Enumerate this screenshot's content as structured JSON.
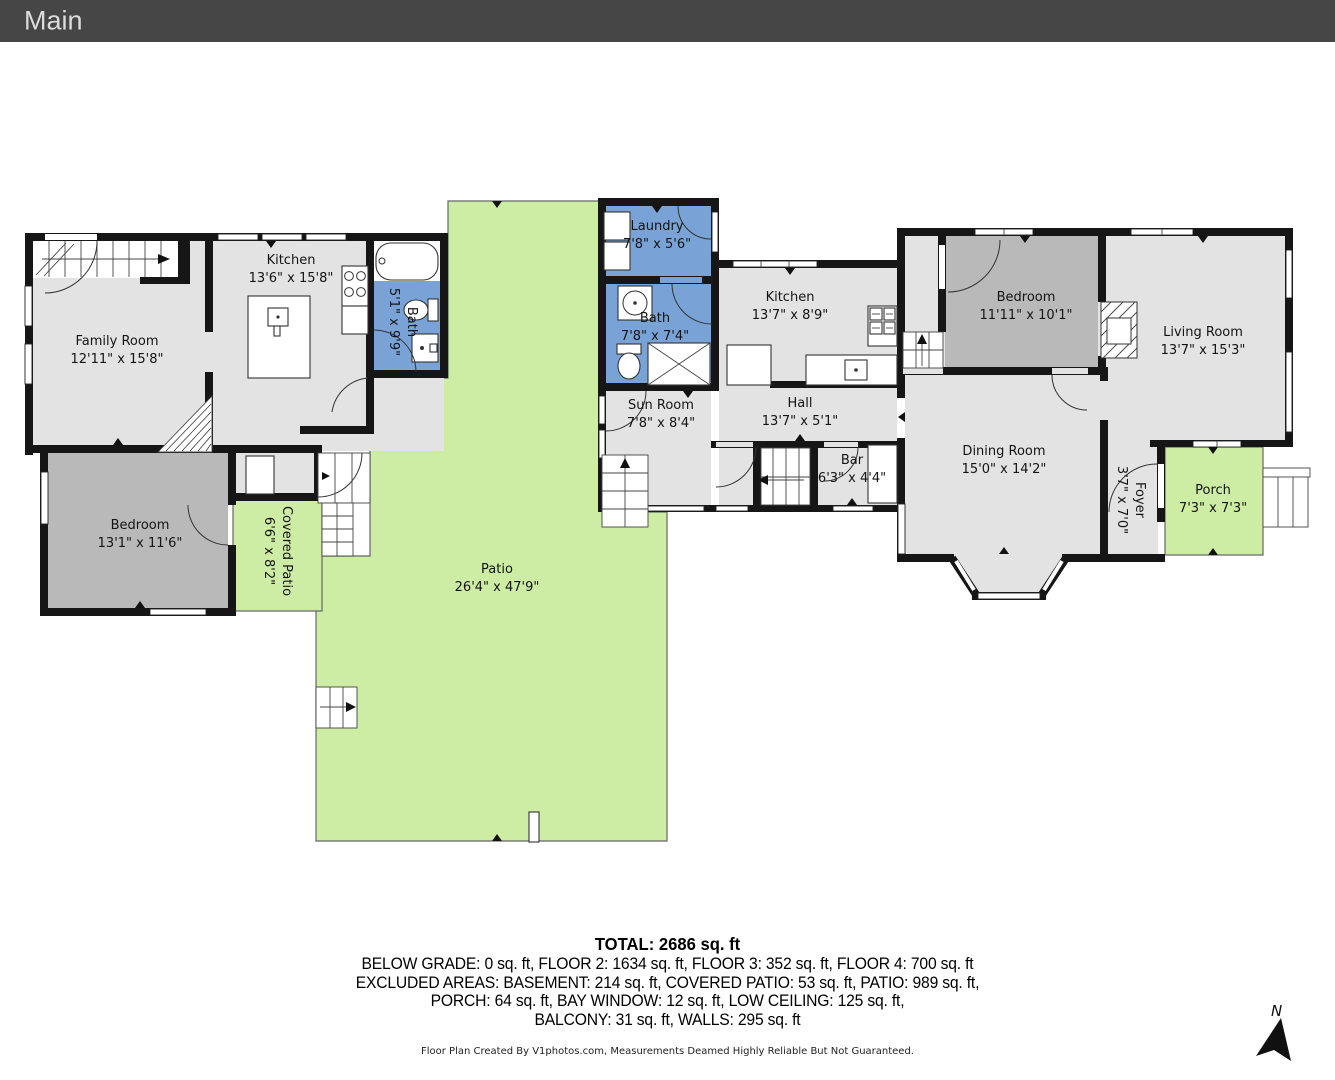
{
  "header": {
    "title": "Main"
  },
  "floorplan": {
    "rooms": [
      {
        "id": "family-room",
        "name": "Family Room",
        "dims": "12'11\" x 15'8\""
      },
      {
        "id": "kitchen-left",
        "name": "Kitchen",
        "dims": "13'6\" x 15'8\""
      },
      {
        "id": "bath-left",
        "name": "Bath",
        "dims": "5'1\" x 9'9\""
      },
      {
        "id": "bedroom-left",
        "name": "Bedroom",
        "dims": "13'1\" x 11'6\""
      },
      {
        "id": "covered-patio",
        "name": "Covered Patio",
        "dims": "6'6\" x 8'2\""
      },
      {
        "id": "patio",
        "name": "Patio",
        "dims": "26'4\" x 47'9\""
      },
      {
        "id": "laundry",
        "name": "Laundry",
        "dims": "7'8\" x 5'6\""
      },
      {
        "id": "bath-middle",
        "name": "Bath",
        "dims": "7'8\" x 7'4\""
      },
      {
        "id": "kitchen-middle",
        "name": "Kitchen",
        "dims": "13'7\" x 8'9\""
      },
      {
        "id": "sun-room",
        "name": "Sun Room",
        "dims": "7'8\" x 8'4\""
      },
      {
        "id": "hall",
        "name": "Hall",
        "dims": "13'7\" x 5'1\""
      },
      {
        "id": "bar",
        "name": "Bar",
        "dims": "6'3\" x 4'4\""
      },
      {
        "id": "bedroom-right",
        "name": "Bedroom",
        "dims": "11'11\" x 10'1\""
      },
      {
        "id": "living-room",
        "name": "Living Room",
        "dims": "13'7\" x 15'3\""
      },
      {
        "id": "dining-room",
        "name": "Dining Room",
        "dims": "15'0\" x 14'2\""
      },
      {
        "id": "foyer",
        "name": "Foyer",
        "dims": "3'7\" x 7'0\""
      },
      {
        "id": "porch",
        "name": "Porch",
        "dims": "7'3\" x 7'3\""
      }
    ],
    "compass_label": "N"
  },
  "summary": {
    "total": "TOTAL: 2686 sq. ft",
    "line2": "BELOW GRADE: 0 sq. ft, FLOOR 2: 1634 sq. ft, FLOOR 3: 352 sq. ft, FLOOR 4: 700 sq. ft",
    "line3": "EXCLUDED AREAS: BASEMENT: 214 sq. ft, COVERED PATIO: 53 sq. ft, PATIO: 989 sq. ft,",
    "line4": "PORCH: 64 sq. ft, BAY WINDOW: 12 sq. ft, LOW CEILING: 125 sq. ft,",
    "line5": "BALCONY: 31 sq. ft, WALLS: 295 sq. ft"
  },
  "footer": {
    "credit": "Floor Plan Created By V1photos.com, Measurements Deamed Highly Reliable But Not Guaranteed."
  },
  "colors": {
    "room_gray": "#e3e3e3",
    "bedroom_gray": "#b9b9b9",
    "bath_blue": "#79a3d6",
    "outdoor_green": "#cdeca4",
    "wall_black": "#161616",
    "header_bg": "#464646"
  }
}
